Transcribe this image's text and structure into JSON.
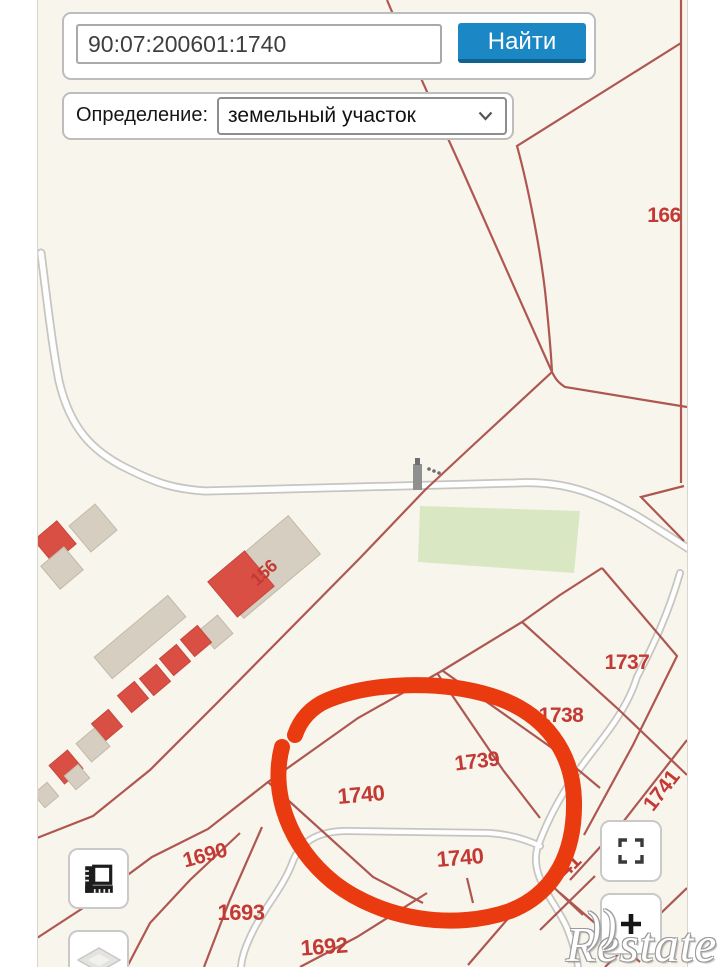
{
  "search": {
    "value": "90:07:200601:1740",
    "button": "Найти"
  },
  "definition": {
    "label": "Определение:",
    "value": "земельный участок"
  },
  "map": {
    "labels": [
      {
        "text": "166",
        "x": 664,
        "y": 216,
        "rot": 0,
        "size": 21
      },
      {
        "text": "156",
        "x": 264,
        "y": 573,
        "rot": -42,
        "size": 18
      },
      {
        "text": "1737",
        "x": 627,
        "y": 663,
        "rot": 0,
        "size": 21
      },
      {
        "text": "1738",
        "x": 561,
        "y": 716,
        "rot": 0,
        "size": 21
      },
      {
        "text": "1739",
        "x": 477,
        "y": 762,
        "rot": -7,
        "size": 21
      },
      {
        "text": "1740",
        "x": 361,
        "y": 795,
        "rot": -5,
        "size": 22
      },
      {
        "text": "1740",
        "x": 460,
        "y": 858,
        "rot": -5,
        "size": 22
      },
      {
        "text": "1741",
        "x": 662,
        "y": 791,
        "rot": -52,
        "size": 21
      },
      {
        "text": "41",
        "x": 570,
        "y": 866,
        "rot": -45,
        "size": 21
      },
      {
        "text": "1690",
        "x": 205,
        "y": 856,
        "rot": -15,
        "size": 21
      },
      {
        "text": "1693",
        "x": 241,
        "y": 913,
        "rot": 0,
        "size": 22
      },
      {
        "text": "1692",
        "x": 324,
        "y": 947,
        "rot": -4,
        "size": 22
      }
    ],
    "colors": {
      "background": "#f8f5ec",
      "boundary_line": "#a64741",
      "parcel_label": "#c23a33",
      "highlight_circle": "#e93a10",
      "road_fill": "#fefefe",
      "road_casing": "#c6c5c0",
      "green_area": "#d9e8c2",
      "building_beige": "#d6cec0",
      "building_red": "#d94f44"
    }
  },
  "controls": {
    "measure": "ruler-icon",
    "layers": "layers-icon",
    "fullscreen": "fullscreen-icon",
    "zoom_in": "plus-icon"
  },
  "watermark": {
    "text": "Restate",
    "arc": "))"
  },
  "accent": {
    "button_bg": "#1b87c4",
    "button_shadow": "#10638f"
  }
}
